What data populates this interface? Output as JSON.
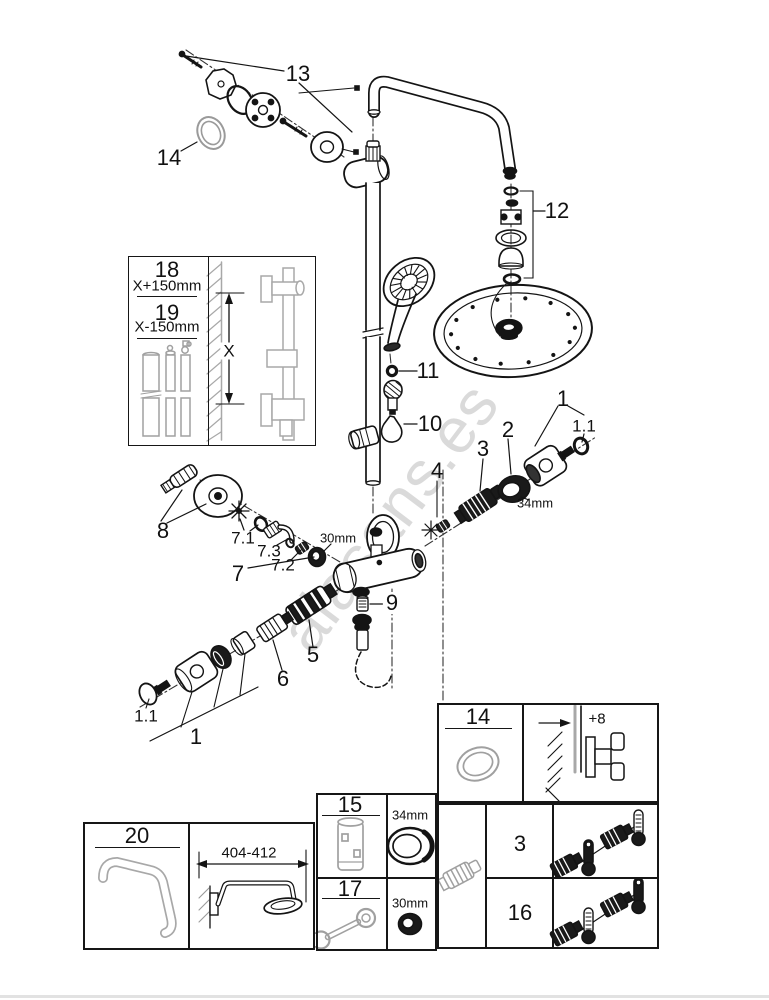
{
  "watermark": "alasans.es",
  "callouts": {
    "n13": "13",
    "n14": "14",
    "n12": "12",
    "n11": "11",
    "n10": "10",
    "n1a": "1",
    "n11a": "1.1",
    "n2": "2",
    "n3": "3",
    "n4": "4",
    "d34": "34mm",
    "n8": "8",
    "n71": "7.1",
    "n73": "7.3",
    "n72": "7.2",
    "n7": "7",
    "d30": "30mm",
    "n9": "9",
    "n5": "5",
    "n6": "6",
    "n11b": "1.1",
    "n1b": "1"
  },
  "length_box": {
    "n18": "18",
    "f18": "X+150mm",
    "n19": "19",
    "f19": "X-150mm",
    "x": "X"
  },
  "arm_box": {
    "n20": "20",
    "dim": "404-412"
  },
  "tables": {
    "n14": "14",
    "plus8": "+8",
    "n15": "15",
    "d34": "34mm",
    "n17": "17",
    "d30": "30mm",
    "n3": "3",
    "n16": "16"
  }
}
